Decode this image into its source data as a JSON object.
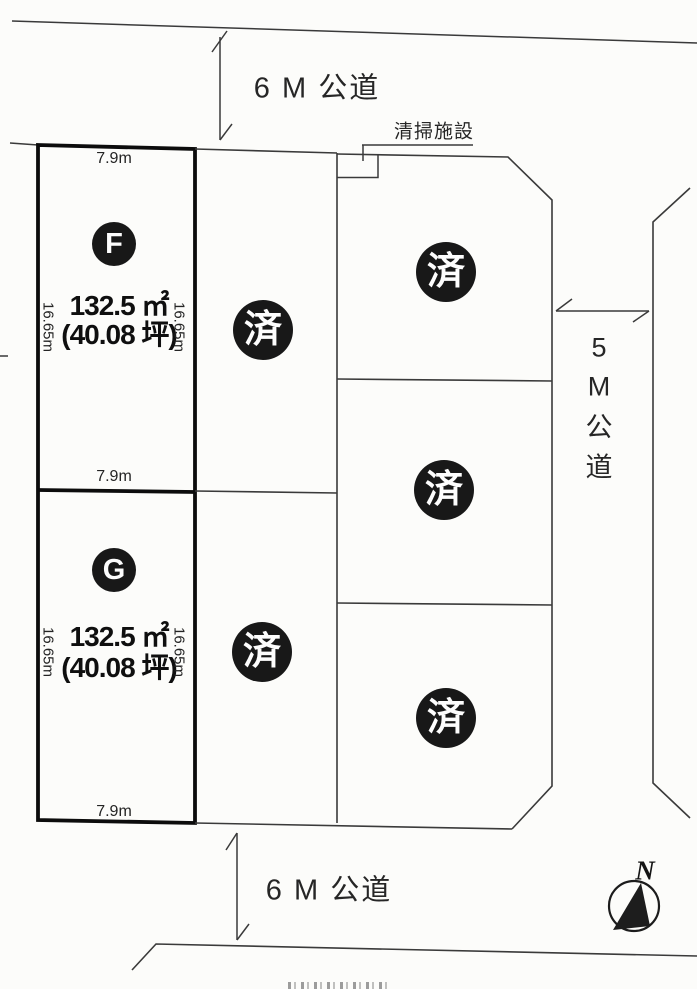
{
  "roads": {
    "top": {
      "label": "6 M 公道"
    },
    "bottom": {
      "label": "6 M 公道"
    },
    "right": {
      "label": "5M公道",
      "chars": [
        "5",
        "M",
        "公",
        "道"
      ]
    }
  },
  "facility": {
    "label": "清掃施設"
  },
  "lots": {
    "f": {
      "id": "F",
      "area_m2": "132.5 ㎡",
      "area_tsubo": "(40.08 坪)",
      "frontage": "7.9m",
      "depth_left": "16.65m",
      "depth_right": "16.65m"
    },
    "g": {
      "id": "G",
      "area_m2": "132.5 ㎡",
      "area_tsubo": "(40.08 坪)",
      "frontage": "7.9m",
      "frontage_bottom": "7.9m",
      "depth_left": "16.65m",
      "depth_right": "16.65m"
    },
    "sold": [
      {
        "label": "済"
      },
      {
        "label": "済"
      },
      {
        "label": "済"
      },
      {
        "label": "済"
      },
      {
        "label": "済"
      }
    ]
  },
  "compass": {
    "label": "N"
  }
}
